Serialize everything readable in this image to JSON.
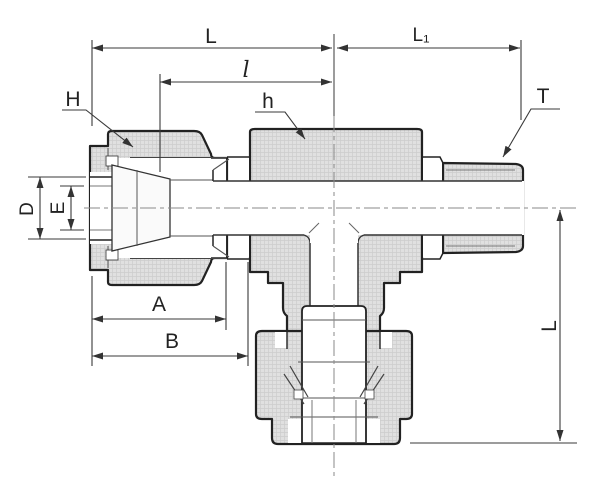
{
  "drawing": {
    "kind": "sectioned technical drawing of a tube fitting (male run tee)",
    "colors": {
      "background": "#ffffff",
      "outline": "#222222",
      "section_fill": "#e0e0e0",
      "section_grid": "#cdcdcd",
      "dimension_line": "#3a3a3a",
      "centerline": "#8a8a8a"
    }
  },
  "labels": {
    "dim_L_top": "L",
    "dim_l_inner": "l",
    "dim_L1": "L₁",
    "callout_H": "H",
    "callout_h": "h",
    "callout_T": "T",
    "dim_D": "D",
    "dim_E": "E",
    "dim_A": "A",
    "dim_B": "B",
    "dim_L_right": "L"
  }
}
